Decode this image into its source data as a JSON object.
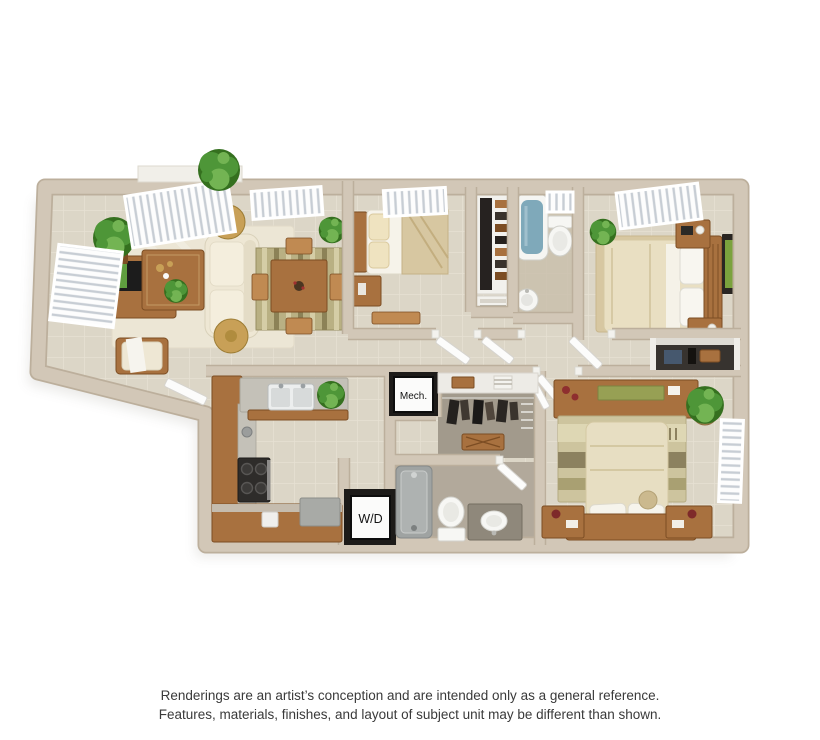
{
  "floorplan": {
    "labels": {
      "mech": "Mech.",
      "washer_dryer": "W/D"
    },
    "colors": {
      "wall": "#d2c7b7",
      "wall_edge": "#bcaf9c",
      "tile": "#dcd6c7",
      "tile_line": "#e7e1d3",
      "bath_floor": "#b2a99b",
      "closet_floor": "#a29a8c",
      "bath2_floor": "#c9bfab",
      "wood": "#a8713f",
      "wood_dark": "#7c4d23",
      "wood_light": "#c08a52",
      "cream": "#eee7d4",
      "cream_dark": "#d9d1ba",
      "white": "#f8f8f6",
      "slat": "#c7cdd4",
      "counter": "#c4c1b8",
      "granite": "#8f887b",
      "appliance": "#2e2c2a",
      "frame_dark": "#1d1b19",
      "plant": "#4e9638",
      "plant_dark": "#35701f",
      "plant_light": "#73b453",
      "water": "#7fa9ba",
      "gold": "#c8a057",
      "rug_tan": "#d7c7a1",
      "rug_cream": "#ece6d5",
      "rug_olive": "#a9a072",
      "rug_brown": "#8c815f"
    }
  },
  "caption": {
    "line1": "Renderings are an artist’s conception and are intended only as a general reference.",
    "line2": "Features, materials, finishes, and layout of subject unit may be different than shown."
  }
}
